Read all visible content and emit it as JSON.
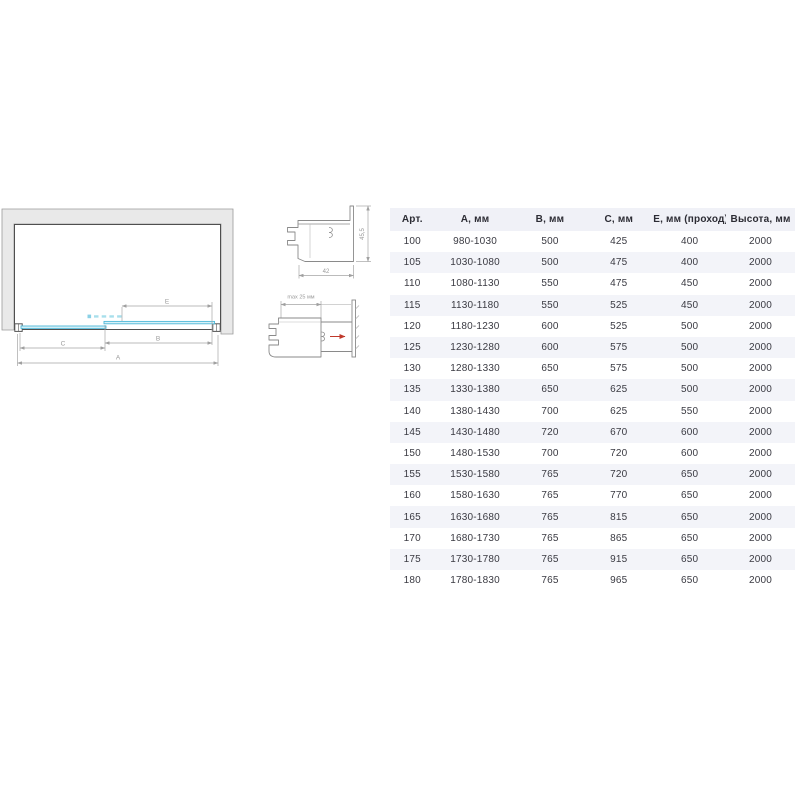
{
  "diagram": {
    "dim_a": "A",
    "dim_b": "B",
    "dim_c": "C",
    "dim_e": "E"
  },
  "profiles": {
    "p1_width": "42",
    "p1_height": "45,5",
    "p2_adjust": "max 25 мм"
  },
  "table": {
    "headers": [
      "Арт.",
      "А, мм",
      "В, мм",
      "С, мм",
      "Е, мм (проход)",
      "Высота, мм"
    ],
    "rows": [
      [
        "100",
        "980-1030",
        "500",
        "425",
        "400",
        "2000"
      ],
      [
        "105",
        "1030-1080",
        "500",
        "475",
        "400",
        "2000"
      ],
      [
        "110",
        "1080-1130",
        "550",
        "475",
        "450",
        "2000"
      ],
      [
        "115",
        "1130-1180",
        "550",
        "525",
        "450",
        "2000"
      ],
      [
        "120",
        "1180-1230",
        "600",
        "525",
        "500",
        "2000"
      ],
      [
        "125",
        "1230-1280",
        "600",
        "575",
        "500",
        "2000"
      ],
      [
        "130",
        "1280-1330",
        "650",
        "575",
        "500",
        "2000"
      ],
      [
        "135",
        "1330-1380",
        "650",
        "625",
        "500",
        "2000"
      ],
      [
        "140",
        "1380-1430",
        "700",
        "625",
        "550",
        "2000"
      ],
      [
        "145",
        "1430-1480",
        "720",
        "670",
        "600",
        "2000"
      ],
      [
        "150",
        "1480-1530",
        "700",
        "720",
        "600",
        "2000"
      ],
      [
        "155",
        "1530-1580",
        "765",
        "720",
        "650",
        "2000"
      ],
      [
        "160",
        "1580-1630",
        "765",
        "770",
        "650",
        "2000"
      ],
      [
        "165",
        "1630-1680",
        "765",
        "815",
        "650",
        "2000"
      ],
      [
        "170",
        "1680-1730",
        "765",
        "865",
        "650",
        "2000"
      ],
      [
        "175",
        "1730-1780",
        "765",
        "915",
        "650",
        "2000"
      ],
      [
        "180",
        "1780-1830",
        "765",
        "965",
        "650",
        "2000"
      ]
    ]
  },
  "colors": {
    "glass_stroke": "#4db8d8",
    "glass_fill": "#d9f1f8",
    "wall_fill": "#e9e9e9",
    "stripe": "#f3f4f9",
    "header_bg": "#f0f1f7",
    "dim": "#a0a0a0",
    "text": "#3a3a42",
    "arrow_red": "#c0392b"
  }
}
